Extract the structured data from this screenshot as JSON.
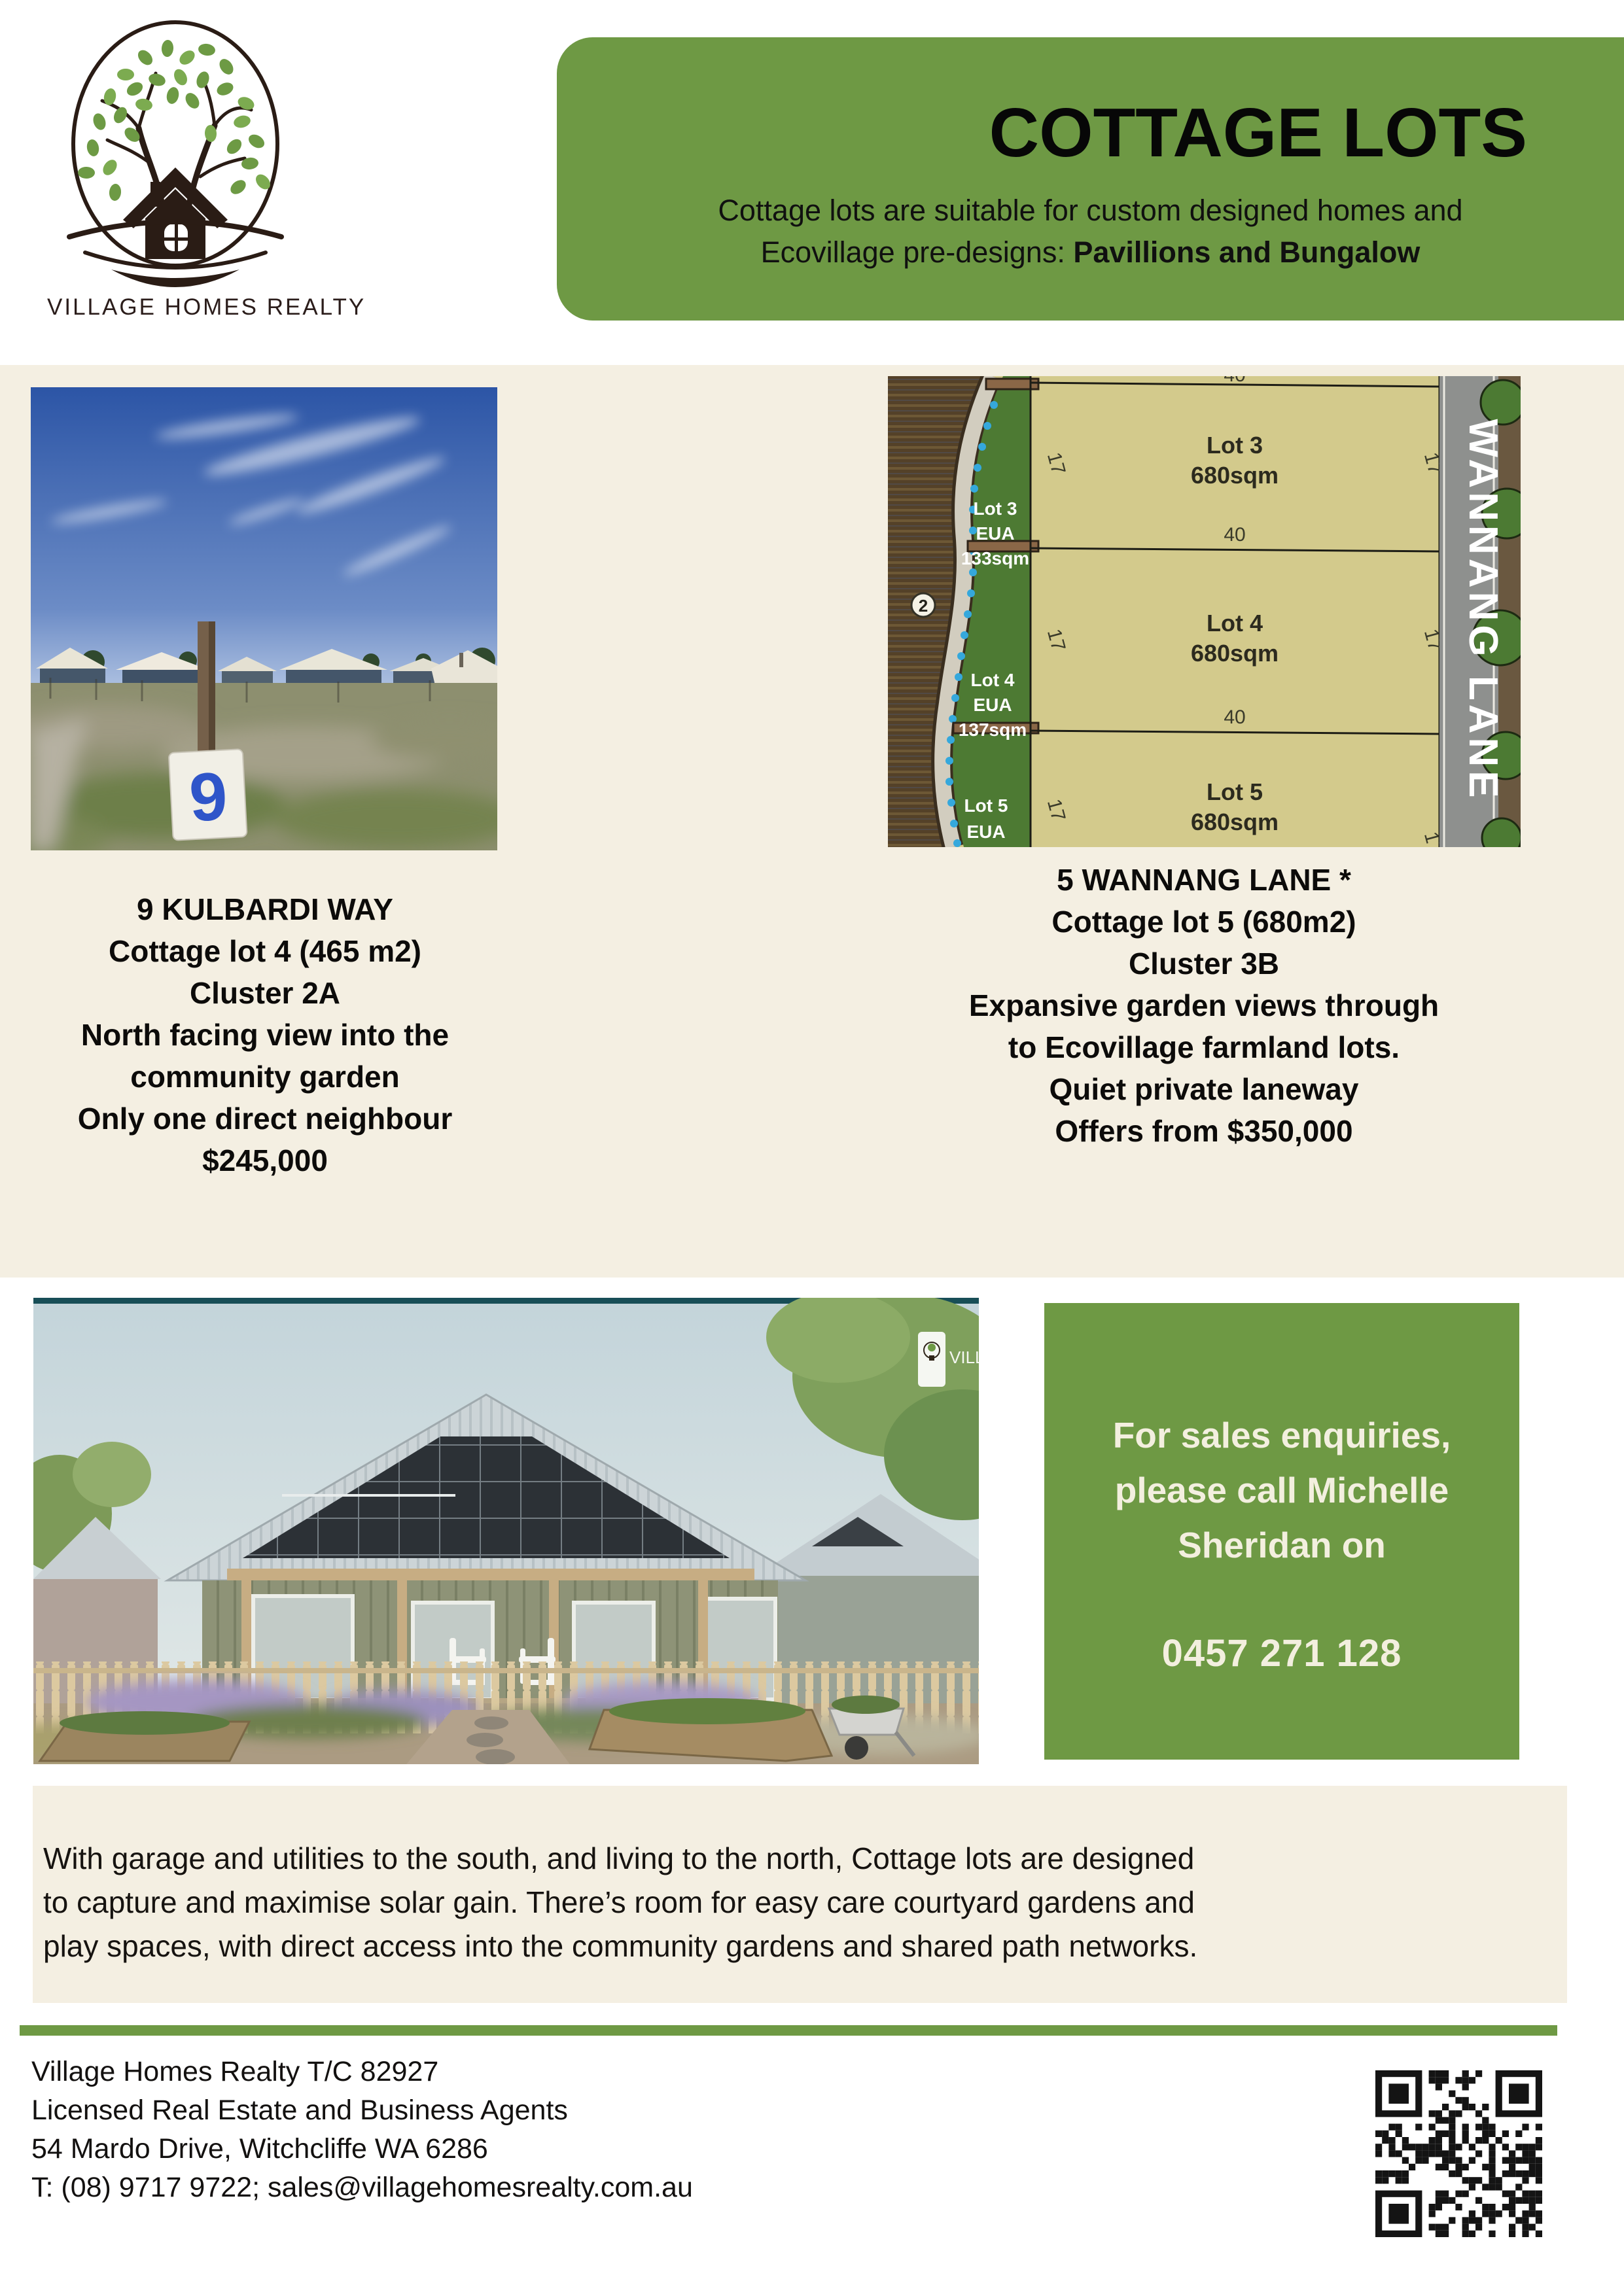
{
  "colors": {
    "brand_green": "#6e9944",
    "cream_background": "#f4efe2",
    "title_black": "#070707",
    "sales_box_text": "#f3efdf"
  },
  "logo": {
    "company": "VILLAGE HOMES REALTY"
  },
  "header": {
    "title": "COTTAGE LOTS",
    "subtitle_line1": "Cottage lots are suitable for custom designed homes and",
    "subtitle_line2_prefix": "Ecovillage pre-designs: ",
    "subtitle_line2_bold": "Pavillions and Bungalow"
  },
  "listing_left": {
    "sign_number": "9",
    "lines": [
      "9 KULBARDI WAY",
      "Cottage lot 4 (465 m2)",
      "Cluster 2A",
      "North facing view into the",
      "community garden",
      "Only one direct neighbour",
      "$245,000"
    ]
  },
  "listing_right": {
    "lines": [
      "5 WANNANG LANE *",
      "Cottage lot 5 (680m2)",
      "Cluster 3B",
      "Expansive garden views through",
      "to Ecovillage farmland lots.",
      "Quiet private laneway",
      "Offers from $350,000"
    ]
  },
  "map": {
    "road_name": "WANNANG LANE",
    "path_marker": "2",
    "eua_labels": [
      {
        "lot": "Lot 3",
        "type": "EUA",
        "area": "133sqm"
      },
      {
        "lot": "Lot 4",
        "type": "EUA",
        "area": "137sqm"
      },
      {
        "lot": "Lot 5",
        "type": "EUA",
        "area": ""
      }
    ],
    "lots": [
      {
        "name": "Lot 3",
        "area": "680sqm",
        "frontage": "40",
        "depth": "17"
      },
      {
        "name": "Lot 4",
        "area": "680sqm",
        "frontage": "40",
        "depth": "17"
      },
      {
        "name": "Lot 5",
        "area": "680sqm",
        "frontage": "40",
        "depth": "17"
      }
    ]
  },
  "sales_box": {
    "lines": [
      "For sales enquiries,",
      "please call Michelle",
      "Sheridan on"
    ],
    "phone": "0457 271 128"
  },
  "about": {
    "lines": [
      "With garage and utilities to the south, and living to the north, Cottage lots are designed",
      "to capture and maximise solar gain. There’s room for easy care courtyard gardens and",
      "play spaces, with direct access into the community gardens and shared path networks."
    ]
  },
  "footer": {
    "lines": [
      "Village Homes Realty T/C 82927",
      "Licensed Real Estate and Business Agents",
      "54 Mardo Drive, Witchcliffe WA 6286",
      "T: (08) 9717 9722; sales@villagehomesrealty.com.au"
    ]
  }
}
